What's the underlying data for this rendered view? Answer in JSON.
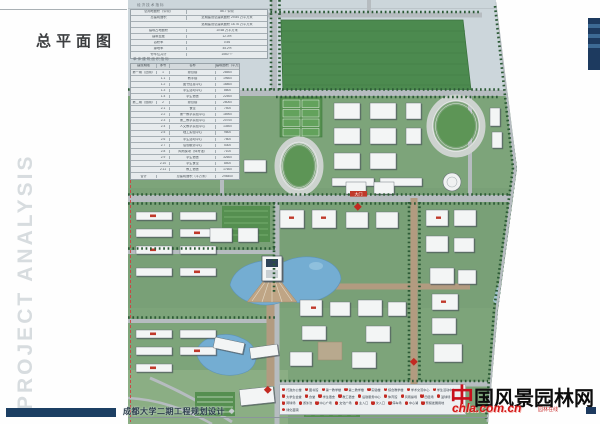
{
  "page": {
    "title": "总平面图",
    "sidebar_text": "PROJECT ANALYSIS",
    "project_name": "成都大学二期工程规划设计",
    "project_suffix": "◆"
  },
  "tables": {
    "economic": {
      "title": "经济技术指标",
      "rows": [
        {
          "label": "总用地面积（公顷）",
          "value": "86.7 公顷"
        },
        {
          "label": "总建筑面积",
          "value": "近期建设总建筑面积 29.84 万平方米"
        },
        {
          "label": "",
          "value": "远期建设总建筑面积 18.76 万平方米"
        },
        {
          "label": "建筑占地面积",
          "value": "10.68 万平方米"
        },
        {
          "label": "建筑密度",
          "value": "12.3%"
        },
        {
          "label": "容积率",
          "value": "0.56"
        },
        {
          "label": "绿地率",
          "value": "45.2%"
        },
        {
          "label": "停车位共计",
          "value": "1560 个"
        }
      ]
    },
    "buildings": {
      "title": "单体建筑面积指标",
      "headers": [
        "建设期限",
        "序号",
        "名称",
        "建筑面积（平方米）"
      ],
      "rows": [
        {
          "phase": "第一期（近期）",
          "no": "1",
          "name": "综合楼",
          "area": "28500"
        },
        {
          "phase": "",
          "no": "1.1",
          "name": "教学楼",
          "area": "19600"
        },
        {
          "phase": "",
          "no": "1.2",
          "name": "图书信息中心",
          "area": "16800"
        },
        {
          "phase": "",
          "no": "1.3",
          "name": "学生活动中心",
          "area": "8600"
        },
        {
          "phase": "",
          "no": "1.4",
          "name": "学生宿舍",
          "area": "22500"
        },
        {
          "phase": "第二期（远期）",
          "no": "2",
          "name": "综合楼",
          "area": "26000"
        },
        {
          "phase": "",
          "no": "2.1",
          "name": "食堂",
          "area": "7400"
        },
        {
          "phase": "",
          "no": "2.2",
          "name": "第一教学实验中心",
          "area": "18900"
        },
        {
          "phase": "",
          "no": "2.3",
          "name": "第二教学实验中心",
          "area": "20700"
        },
        {
          "phase": "",
          "no": "2.4",
          "name": "人文教学实验中心",
          "area": "13500"
        },
        {
          "phase": "",
          "no": "2.5",
          "name": "理工实验中心",
          "area": "9600"
        },
        {
          "phase": "",
          "no": "2.6",
          "name": "学生活动中心",
          "area": "7800"
        },
        {
          "phase": "",
          "no": "2.7",
          "name": "后勤服务中心",
          "area": "5300"
        },
        {
          "phase": "",
          "no": "2.8",
          "name": "风雨操场（体育馆）",
          "area": "7100"
        },
        {
          "phase": "",
          "no": "2.9",
          "name": "学生宿舍",
          "area": "32600"
        },
        {
          "phase": "",
          "no": "2.10",
          "name": "学生食堂",
          "area": "8400"
        },
        {
          "phase": "",
          "no": "2.11",
          "name": "教工宿舍",
          "area": "17600"
        },
        {
          "phase": "合计",
          "no": "",
          "name": "总建筑面积（平方米）",
          "area": "298400"
        }
      ]
    }
  },
  "map": {
    "gate_label": "大门"
  },
  "legend": {
    "items": [
      {
        "n": "1",
        "label": "行政办公楼"
      },
      {
        "n": "2",
        "label": "图书馆"
      },
      {
        "n": "3",
        "label": "第一教学楼"
      },
      {
        "n": "4",
        "label": "第二教学楼"
      },
      {
        "n": "5",
        "label": "实验楼"
      },
      {
        "n": "6",
        "label": "综合教学楼"
      },
      {
        "n": "7",
        "label": "学术交流中心"
      },
      {
        "n": "8",
        "label": "学生活动中心"
      },
      {
        "n": "9",
        "label": "大学生会堂"
      },
      {
        "n": "10",
        "label": "食堂"
      },
      {
        "n": "11",
        "label": "学生宿舍"
      },
      {
        "n": "12",
        "label": "教工宿舍"
      },
      {
        "n": "13",
        "label": "后勤服务中心"
      },
      {
        "n": "14",
        "label": "体育馆"
      },
      {
        "n": "15",
        "label": "风雨操场"
      },
      {
        "n": "16",
        "label": "田径场"
      },
      {
        "n": "17",
        "label": "篮球场"
      },
      {
        "n": "18",
        "label": "网球场"
      },
      {
        "n": "19",
        "label": "游泳池"
      },
      {
        "n": "20",
        "label": "中心广场"
      },
      {
        "n": "21",
        "label": "文化广场"
      },
      {
        "n": "22",
        "label": "主入口"
      },
      {
        "n": "23",
        "label": "次入口"
      },
      {
        "n": "24",
        "label": "停车场"
      },
      {
        "n": "25",
        "label": "中心湖"
      },
      {
        "n": "26",
        "label": "预留发展用地"
      },
      {
        "n": "27",
        "label": "绿化苗圃"
      }
    ]
  },
  "watermark": {
    "zhong": "中",
    "title_rest": "国风景园林网",
    "domain": "chla.com.cn",
    "tagline": "园林在线"
  },
  "colors": {
    "campus_green": "#7da47a",
    "field_green": "#4c8a4f",
    "water_blue": "#74add2",
    "road_grey": "#b6bcc0",
    "axis_tan": "#b29b80",
    "navy": "#1c3f63",
    "marker_red": "#c22a22"
  }
}
